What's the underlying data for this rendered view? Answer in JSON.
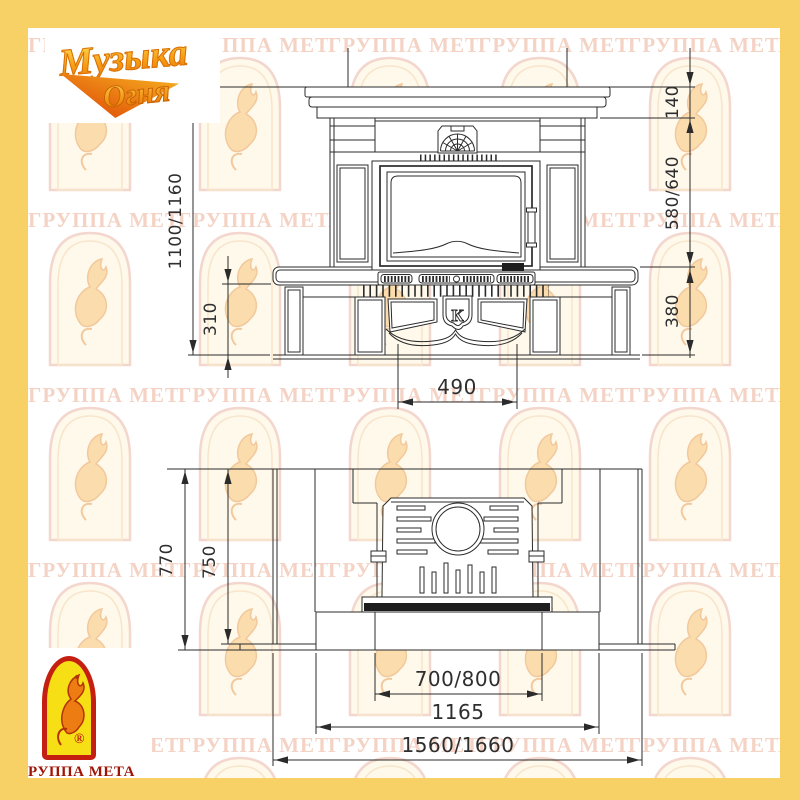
{
  "frame": {
    "color": "#f8d166"
  },
  "logo_top": {
    "line1": "Музыка",
    "line2": "Огня"
  },
  "logo_bottom": {
    "text": "ГРУППА МЕТА",
    "registered": "®"
  },
  "watermark": {
    "text": "ГРУППА МЕТА",
    "text_color": "#f4d3c5"
  },
  "front_view": {
    "badge_letter": "К",
    "dims": {
      "height_total": "1100/1160",
      "base_height": "310",
      "mantel_height": "140",
      "firebox_height": "580/640",
      "plinth_height": "380",
      "arch_width": "490"
    }
  },
  "top_view": {
    "dims": {
      "depth_total": "770",
      "depth_body": "750",
      "hearth_front_width": "700/800",
      "body_width": "1165",
      "total_width": "1560/1660"
    }
  }
}
